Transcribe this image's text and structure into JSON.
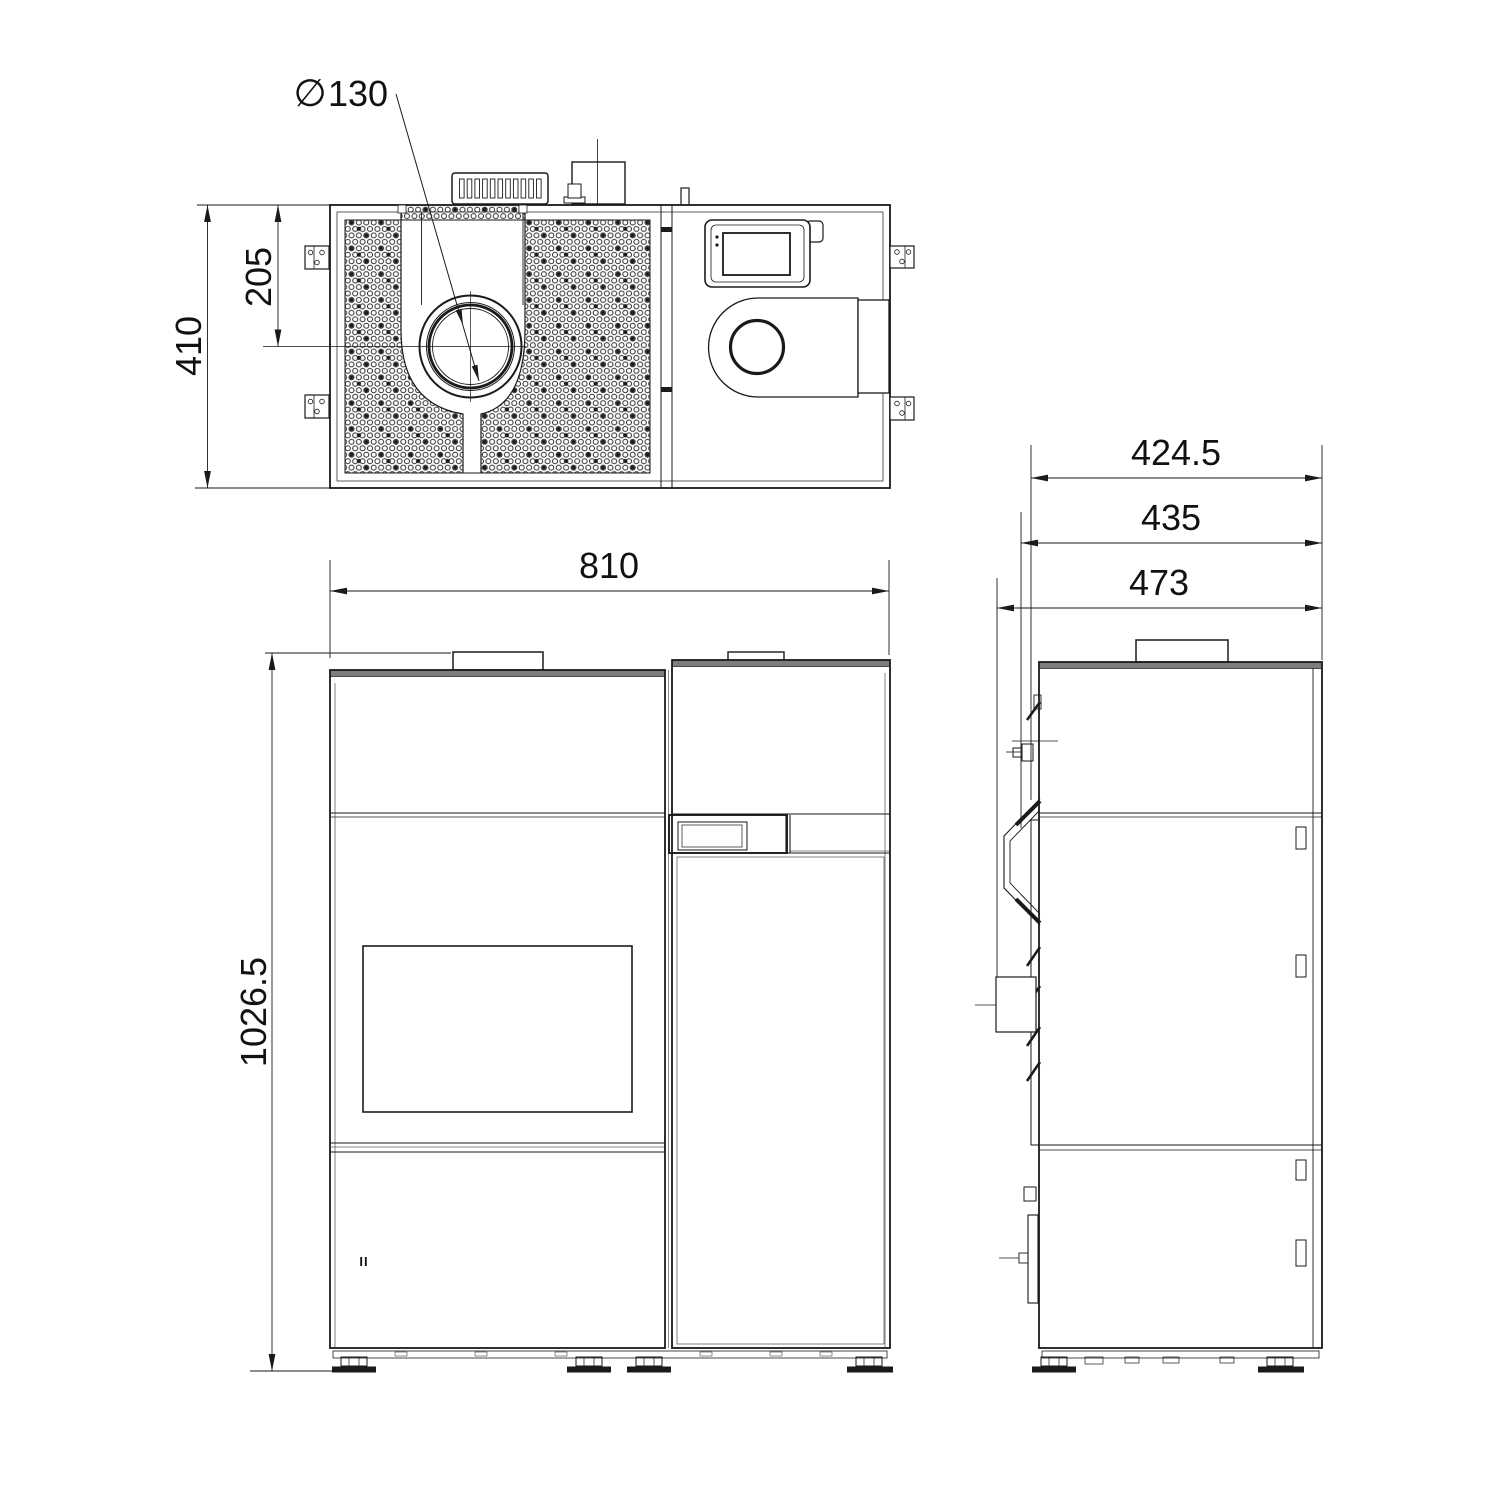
{
  "drawing": {
    "type": "technical-drawing",
    "background": "#ffffff",
    "line_color": "#1a1a1a",
    "dimensions": {
      "top_depth": "410",
      "flue_offset": "205",
      "flue_diameter_symbol": "∅",
      "flue_diameter": "130",
      "front_width": "810",
      "front_height": "1026.5",
      "side_depth_top": "424.5",
      "side_depth_mid": "435",
      "side_depth_overall": "473"
    },
    "marks": {
      "lower_door": "II"
    }
  }
}
